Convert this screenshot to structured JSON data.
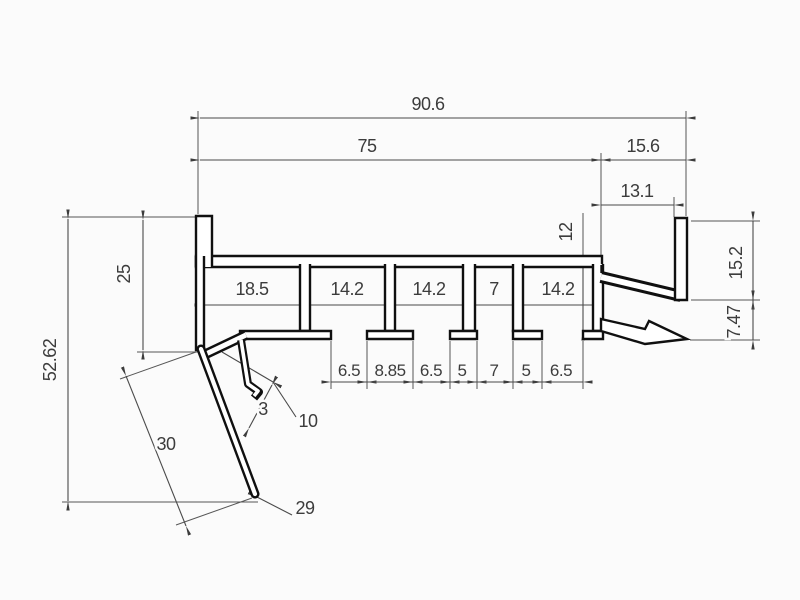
{
  "drawing": {
    "title": "aluminum-profile-cross-section",
    "dims": {
      "overall_width": "90.6",
      "upper_width": "75",
      "right_upper": "15.6",
      "bar_offset": "13.1",
      "channel_height": "12",
      "right_height": "15.2",
      "right_drop": "7.47",
      "left_depth": "25",
      "total_height": "52.62",
      "ch1": "18.5",
      "ch2": "14.2",
      "ch3": "14.2",
      "ch4": "7",
      "ch5": "14.2",
      "slot1": "6.5",
      "foot1": "8.85",
      "slot2": "6.5",
      "foot2": "5",
      "slot3": "7",
      "foot3": "5",
      "slot4": "6.5",
      "hook_gap": "3",
      "hook_length": "10",
      "leg_length_outer": "30",
      "leg_length_inner": "29"
    }
  }
}
